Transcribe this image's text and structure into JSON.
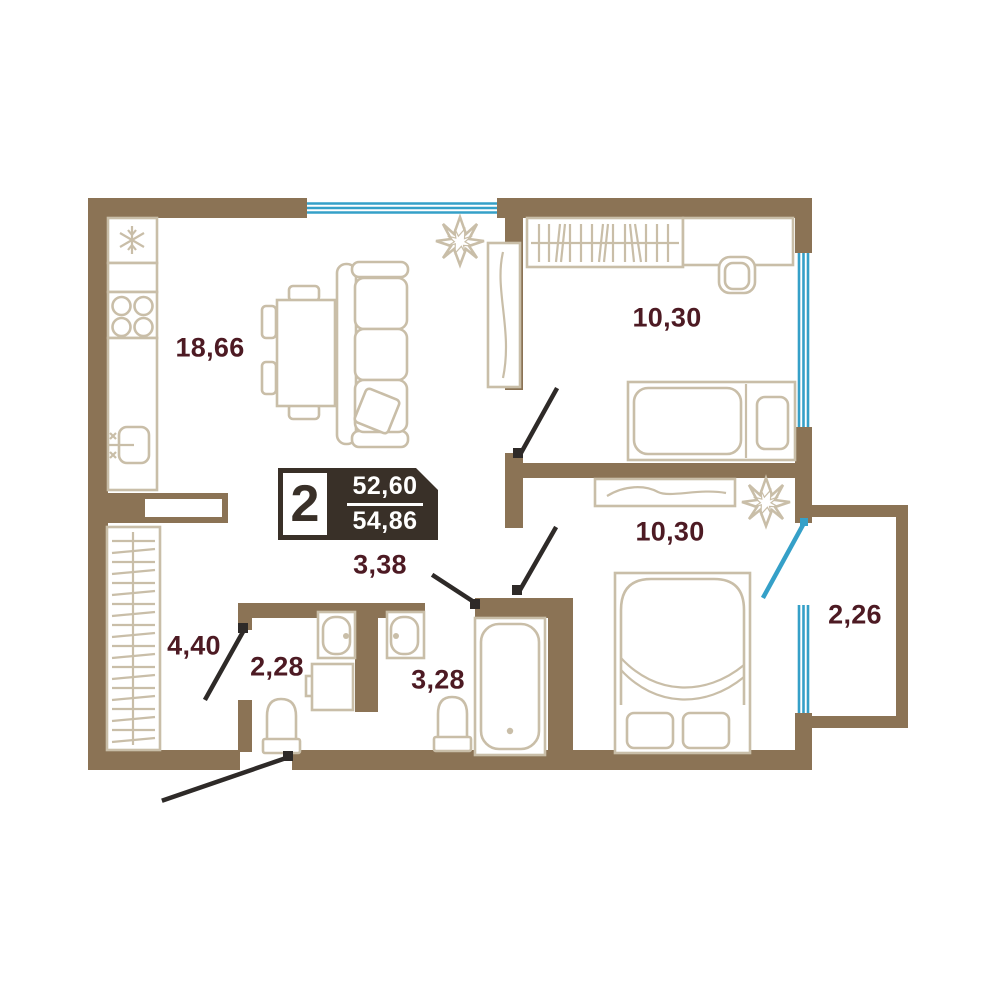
{
  "plan": {
    "badge": {
      "rooms_count": "2",
      "area_upper": "52,60",
      "area_lower": "54,86"
    },
    "rooms": [
      {
        "id": "kitchen-living",
        "area_label": "18,66"
      },
      {
        "id": "bedroom-top",
        "area_label": "10,30"
      },
      {
        "id": "bedroom-bottom",
        "area_label": "10,30"
      },
      {
        "id": "hallway",
        "area_label": "3,38"
      },
      {
        "id": "corridor",
        "area_label": "4,40"
      },
      {
        "id": "wc-small",
        "area_label": "2,28"
      },
      {
        "id": "bathroom",
        "area_label": "3,28"
      },
      {
        "id": "balcony",
        "area_label": "2,26"
      }
    ],
    "colors": {
      "wall": "#8b7355",
      "furniture": "#c9bea8",
      "label": "#4d1a23",
      "window": "#35a0c8",
      "door": "#2e2a28",
      "badge_bg": "#393028",
      "background": "#ffffff"
    }
  }
}
